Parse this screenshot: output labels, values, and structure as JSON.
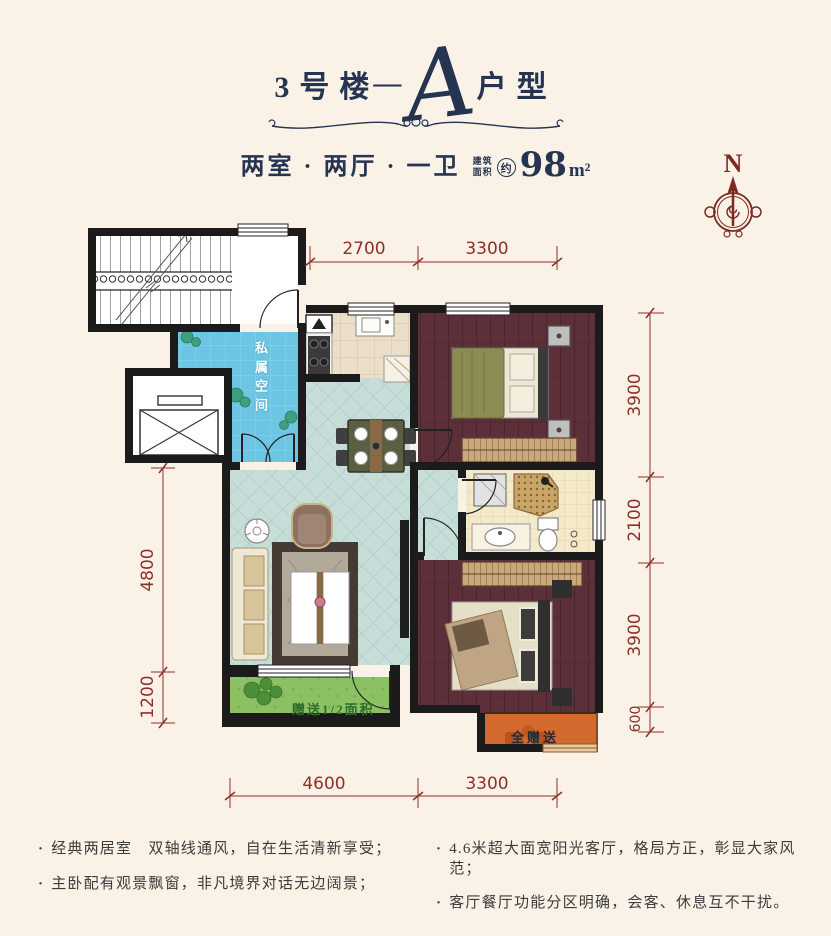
{
  "header": {
    "building": "3号楼",
    "dash": "—",
    "unit_letter": "A",
    "unit_suffix": "户型",
    "layout": "两室 · 两厅 · 一卫",
    "area_label_top": "建筑",
    "area_label_bottom": "面积",
    "area_circle": "约",
    "area_number": "98",
    "area_unit": "m²"
  },
  "compass": {
    "north": "N"
  },
  "plan": {
    "labels": {
      "private_space": "私属空间",
      "balcony_gift": "赠送1/2面积",
      "full_gift": "全赠送"
    },
    "dimensions": {
      "top": [
        "2700",
        "3300"
      ],
      "right": [
        "3900",
        "2100",
        "3900",
        "600"
      ],
      "left": [
        "4800",
        "1200"
      ],
      "bottom": [
        "4600",
        "3300"
      ]
    }
  },
  "features": {
    "bullet": "·",
    "left": [
      "经典两居室　双轴线通风，自在生活清新享受；",
      "主卧配有观景飘窗，非凡境界对话无边阔景；"
    ],
    "right": [
      "4.6米超大面宽阳光客厅，格局方正，彰显大家风范；",
      "客厅餐厅功能分区明确，会客、休息互不干扰。"
    ]
  },
  "colors": {
    "background": "#faf2e7",
    "navy": "#253450",
    "dimension_red": "#8e2f28",
    "wall_black": "#1b1b1b",
    "private_blue": "#6cc5e3",
    "tile_teal": "#c6ddd8",
    "wood_maroon": "#5d3039",
    "balcony_green": "#8cc163",
    "gift_orange": "#d4692f"
  }
}
